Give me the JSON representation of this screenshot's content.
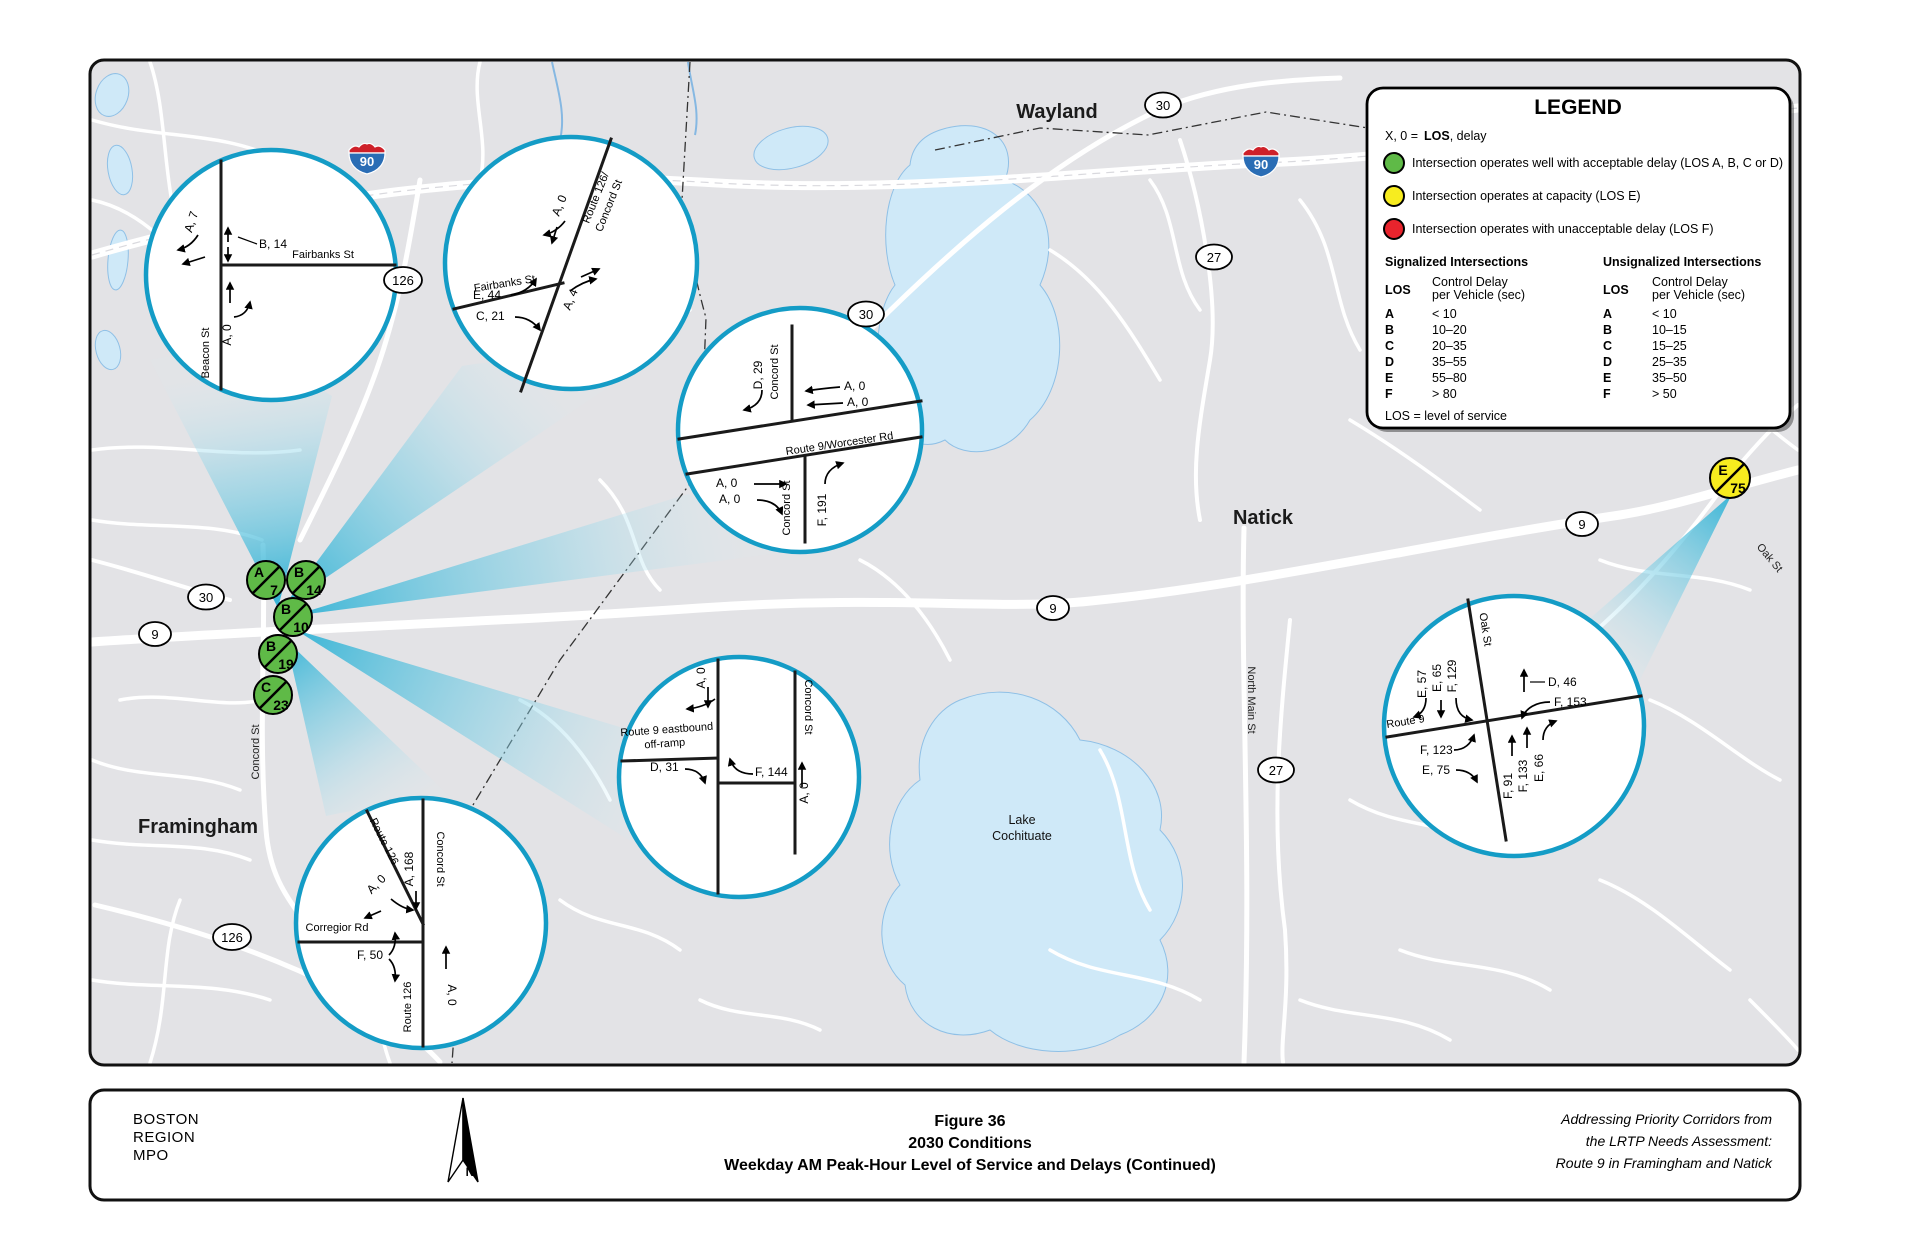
{
  "colors": {
    "good": "#5fba47",
    "capacity": "#f7ec1f",
    "unacceptable": "#e8242d",
    "callout": "#149cc6",
    "wedge": "#29b0d4"
  },
  "legend": {
    "title": "LEGEND",
    "key": {
      "prefix": "X, 0  =",
      "los": "LOS",
      "suffix": ", delay"
    },
    "items": [
      {
        "label": "Intersection operates well with acceptable delay (LOS A, B, C or D)"
      },
      {
        "label": "Intersection operates at capacity (LOS E)"
      },
      {
        "label": "Intersection operates with unacceptable delay (LOS F)"
      }
    ],
    "signalized": {
      "title": "Signalized Intersections",
      "los": "LOS",
      "delay1": "Control Delay",
      "delay2": "per Vehicle (sec)",
      "rows": [
        [
          "A",
          "< 10"
        ],
        [
          "B",
          "10–20"
        ],
        [
          "C",
          "20–35"
        ],
        [
          "D",
          "35–55"
        ],
        [
          "E",
          "55–80"
        ],
        [
          "F",
          "> 80"
        ]
      ]
    },
    "unsignalized": {
      "title": "Unsignalized Intersections",
      "los": "LOS",
      "delay1": "Control Delay",
      "delay2": "per Vehicle (sec)",
      "rows": [
        [
          "A",
          "< 10"
        ],
        [
          "B",
          "10–15"
        ],
        [
          "C",
          "15–25"
        ],
        [
          "D",
          "25–35"
        ],
        [
          "E",
          "35–50"
        ],
        [
          "F",
          "> 50"
        ]
      ]
    },
    "footnote": "LOS = level of service"
  },
  "map": {
    "towns": {
      "wayland": "Wayland",
      "natick": "Natick",
      "framingham": "Framingham"
    },
    "lake": {
      "line1": "Lake",
      "line2": "Cochituate"
    },
    "roads": {
      "north_main": "North Main St",
      "oak": "Oak St",
      "concord": "Concord St"
    },
    "shields": {
      "i90": "90",
      "r9": "9",
      "r27": "27",
      "r30": "30",
      "r126": "126"
    },
    "badges": [
      {
        "los": "A",
        "delay": "7"
      },
      {
        "los": "B",
        "delay": "14"
      },
      {
        "los": "B",
        "delay": "10"
      },
      {
        "los": "B",
        "delay": "19"
      },
      {
        "los": "C",
        "delay": "23"
      },
      {
        "los": "E",
        "delay": "75"
      }
    ]
  },
  "callouts": {
    "c1": {
      "street_v": "Beacon St",
      "street_h": "Fairbanks St",
      "a7": "A, 7",
      "b14": "B, 14",
      "a0": "A, 0"
    },
    "c2": {
      "street_h": "Fairbanks St",
      "route1": "Route 126/",
      "route2": "Concord St",
      "a0": "A, 0",
      "e44": "E, 44",
      "c21": "C, 21",
      "a4": "A, 4"
    },
    "c3": {
      "street_top": "Concord St",
      "street_bot": "Concord St",
      "route": "Route 9/Worcester Rd",
      "d29": "D, 29",
      "a0_1": "A, 0",
      "a0_2": "A, 0",
      "a0_3": "A, 0",
      "a0_4": "A, 0",
      "f191": "F, 191"
    },
    "c4": {
      "ramp1": "Route 9 eastbound",
      "ramp2": "off-ramp",
      "street": "Concord St",
      "a0_top": "A, 0",
      "d31": "D, 31",
      "f144": "F, 144",
      "a0_right": "A, 0"
    },
    "c5": {
      "street_top": "Concord St",
      "street_bot": "Route 126",
      "route_d": "Route 126",
      "street_h": "Corregior Rd",
      "a168": "A, 168",
      "a0_d": "A, 0",
      "f50": "F, 50",
      "a0_s": "A, 0"
    },
    "c6": {
      "route": "Route 9",
      "street": "Oak St",
      "e57": "E, 57",
      "e65": "E, 65",
      "f129": "F, 129",
      "d46": "D, 46",
      "f153": "F, 153",
      "f123": "F, 123",
      "e75": "E, 75",
      "f91": "F, 91",
      "f133": "F, 133",
      "e66": "E, 66"
    }
  },
  "footer": {
    "agency": [
      "BOSTON",
      "REGION",
      "MPO"
    ],
    "north": "N",
    "title": [
      "Figure 36",
      "2030 Conditions",
      "Weekday AM Peak-Hour Level of Service and Delays (Continued)"
    ],
    "credit": [
      "Addressing Priority Corridors from",
      "the LRTP Needs Assessment:",
      "Route 9 in Framingham and Natick"
    ]
  }
}
